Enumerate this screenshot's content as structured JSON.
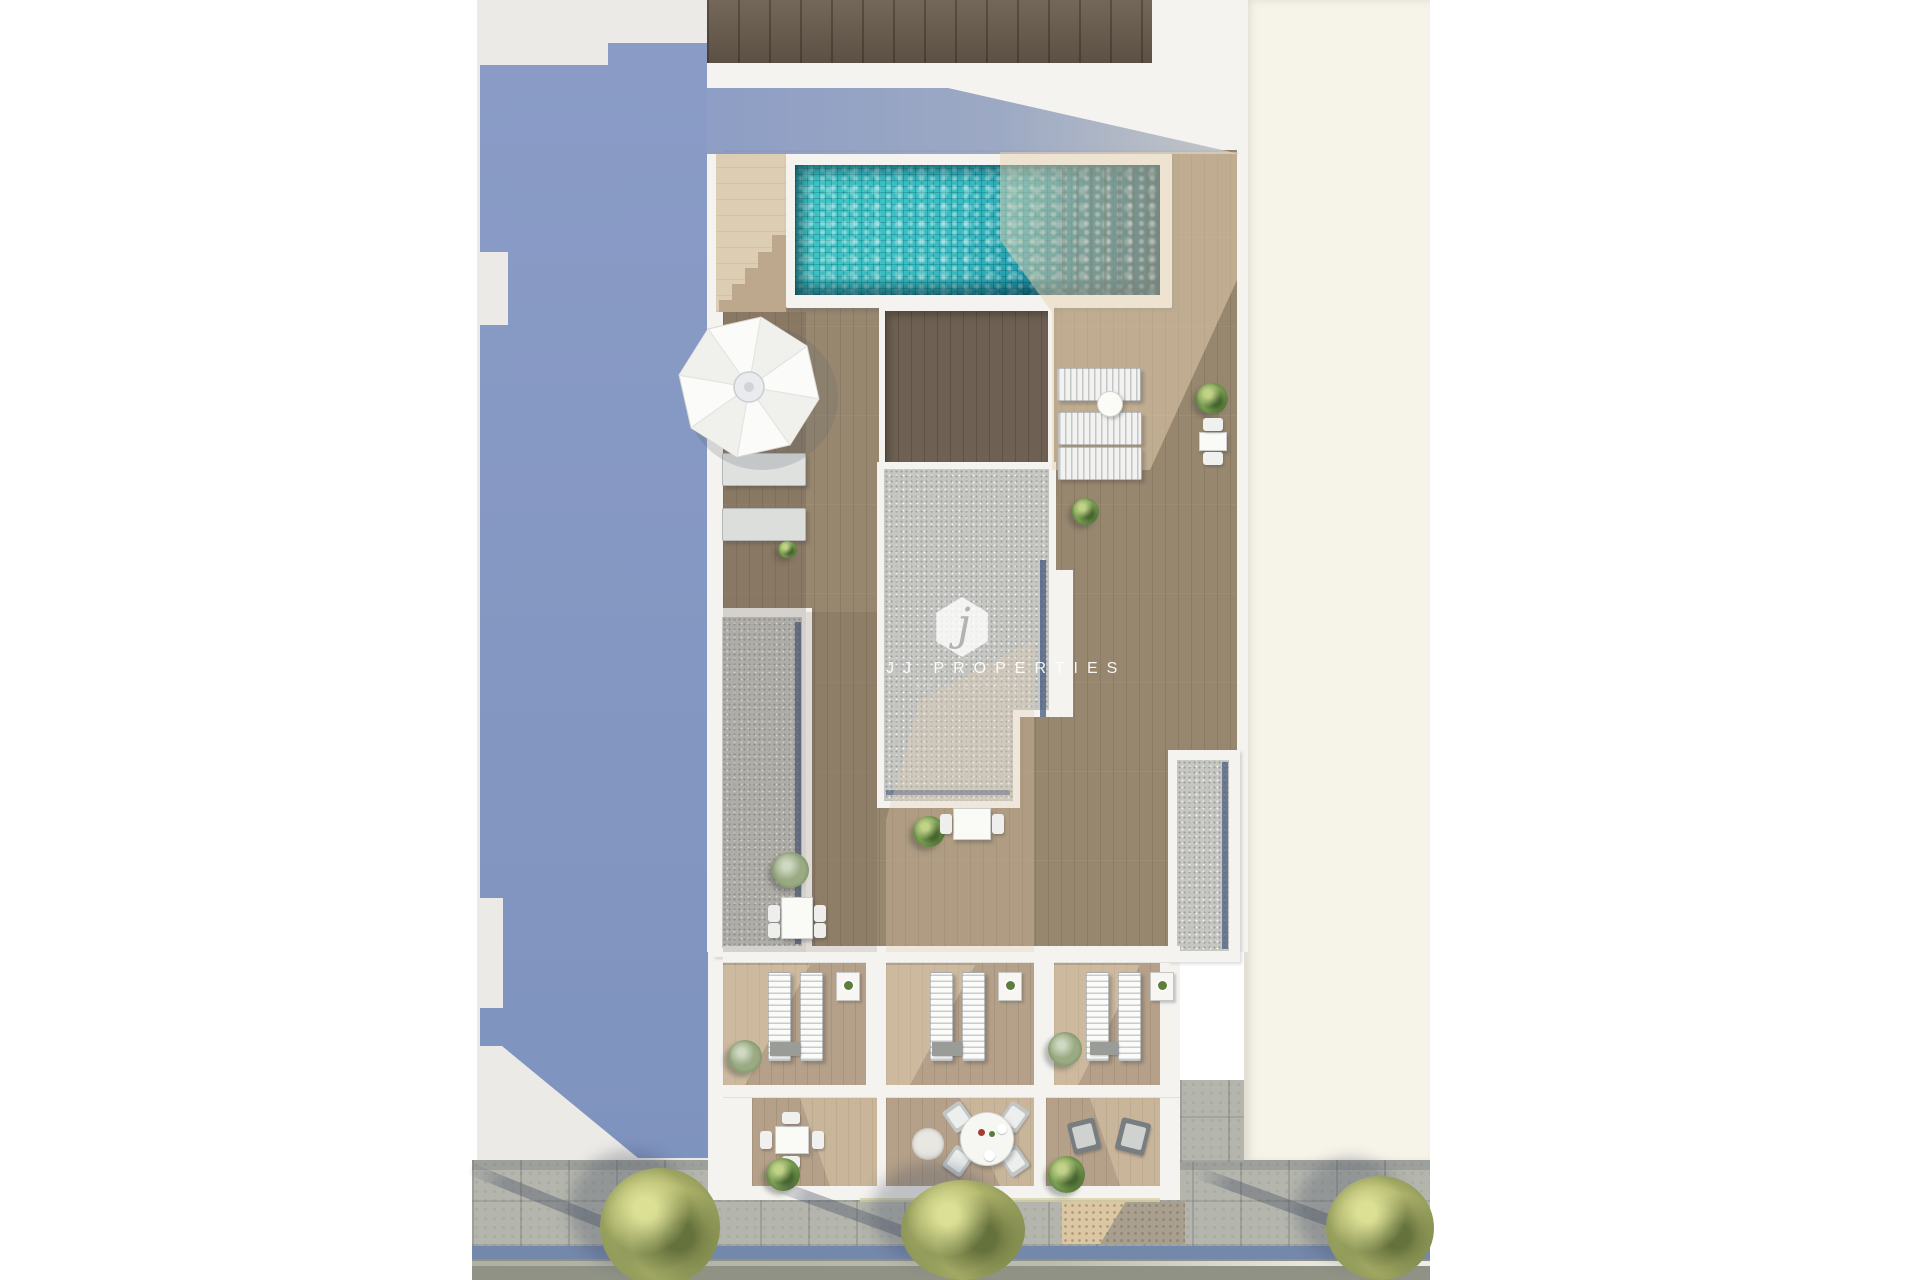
{
  "scene": {
    "description": "Top-down 3D architectural render of a rooftop terrace of a residential building",
    "inventory": {
      "swimming_pools": 1,
      "parasols": 1,
      "sun_loungers": 11,
      "gravel_roof_sections": 3,
      "private_terraces_middle_row": 3,
      "private_terraces_bottom_row": 3,
      "dining_table_sets": 5,
      "armchairs": 2,
      "street_trees": 3,
      "shrubs": 9
    }
  },
  "logo": {
    "monogram": "j",
    "name": "JJ PROPERTIES",
    "tagline": "REAL ESTATE"
  },
  "palette": {
    "canvas_white": "#ffffff",
    "neighbor_roof_gray": "#eceae6",
    "building_shadow_blue": "#8598c2",
    "wall_white": "#f4f3ef",
    "wood_deck": "#98876f",
    "wood_terrace_light": "#b5a189",
    "wood_recessed_dark": "#6e6052",
    "wood_top_band": "#6b5e4f",
    "gravel_gray": "#c6c7c3",
    "gravel_shadow_line": "#44597d",
    "pool_water_turquoise": "#38bcc2",
    "pool_water_deep": "#0c4f63",
    "stairs_beige": "#ddcdb2",
    "neighbor_building_cream": "#f6f3e9",
    "sidewalk_gray": "#b4b5ad",
    "curb_blue": "#7488ac",
    "road_gray": "#8f9285",
    "tactile_ramp_tan": "#dcc7a4",
    "tree_canopy_green": "#b0b46c"
  }
}
